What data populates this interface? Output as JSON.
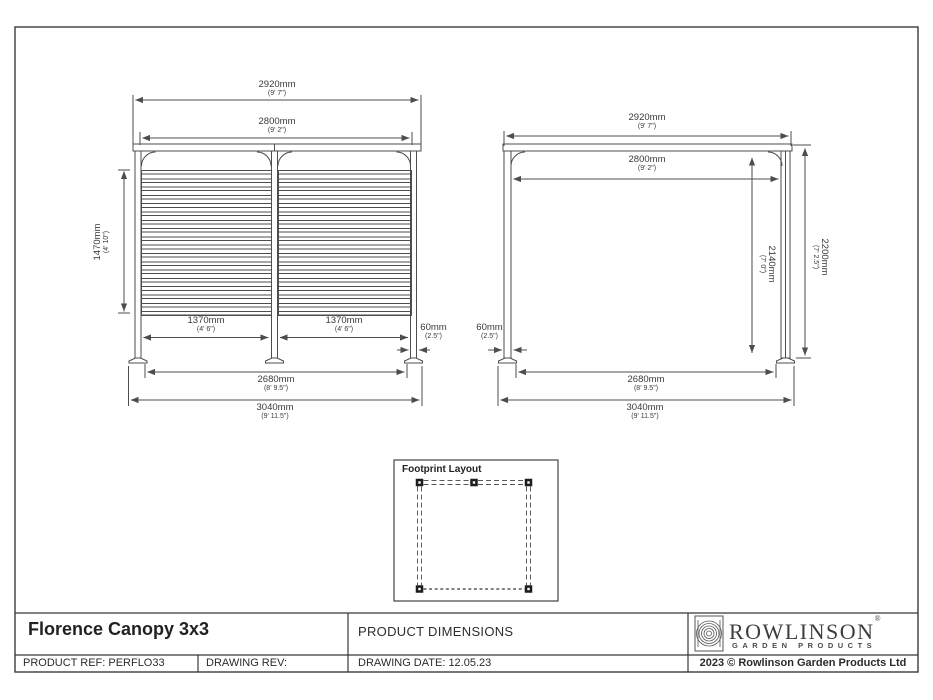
{
  "front_view": {
    "dims": {
      "overall_width": {
        "metric": "2920mm",
        "imperial": "(9' 7\")"
      },
      "inner_width": {
        "metric": "2800mm",
        "imperial": "(9' 2\")"
      },
      "screen_height": {
        "metric": "1470mm",
        "imperial": "(4' 10\")"
      },
      "bay_left": {
        "metric": "1370mm",
        "imperial": "(4' 6\")"
      },
      "bay_right": {
        "metric": "1370mm",
        "imperial": "(4' 6\")"
      },
      "post_width": {
        "metric": "60mm",
        "imperial": "(2.5\")"
      },
      "post_spacing": {
        "metric": "2680mm",
        "imperial": "(8' 9.5\")"
      },
      "base_width": {
        "metric": "3040mm",
        "imperial": "(9' 11.5\")"
      }
    }
  },
  "side_view": {
    "dims": {
      "overall_depth": {
        "metric": "2920mm",
        "imperial": "(9' 7\")"
      },
      "inner_depth": {
        "metric": "2800mm",
        "imperial": "(9' 2\")"
      },
      "clear_height": {
        "metric": "2140mm",
        "imperial": "(7' 0\")"
      },
      "overall_height": {
        "metric": "2200mm",
        "imperial": "(7' 2.5\")"
      },
      "post_width": {
        "metric": "60mm",
        "imperial": "(2.5\")"
      },
      "post_spacing": {
        "metric": "2680mm",
        "imperial": "(8' 9.5\")"
      },
      "base_depth": {
        "metric": "3040mm",
        "imperial": "(9' 11.5\")"
      }
    }
  },
  "footprint": {
    "title": "Footprint Layout"
  },
  "title_block": {
    "product_title": "Florence Canopy 3x3",
    "sheet_title": "PRODUCT DIMENSIONS",
    "product_ref": "PRODUCT REF: PERFLO33",
    "drawing_rev": "DRAWING REV:",
    "drawing_date": "DRAWING DATE: 12.05.23",
    "copyright": "2023 © Rowlinson Garden Products Ltd",
    "brand_name": "ROWLINSON",
    "brand_mark": "®",
    "brand_subtitle": "GARDEN PRODUCTS"
  },
  "colors": {
    "line": "#4d4d4d",
    "text": "#3a3a3a",
    "border": "#3c3c3c"
  }
}
